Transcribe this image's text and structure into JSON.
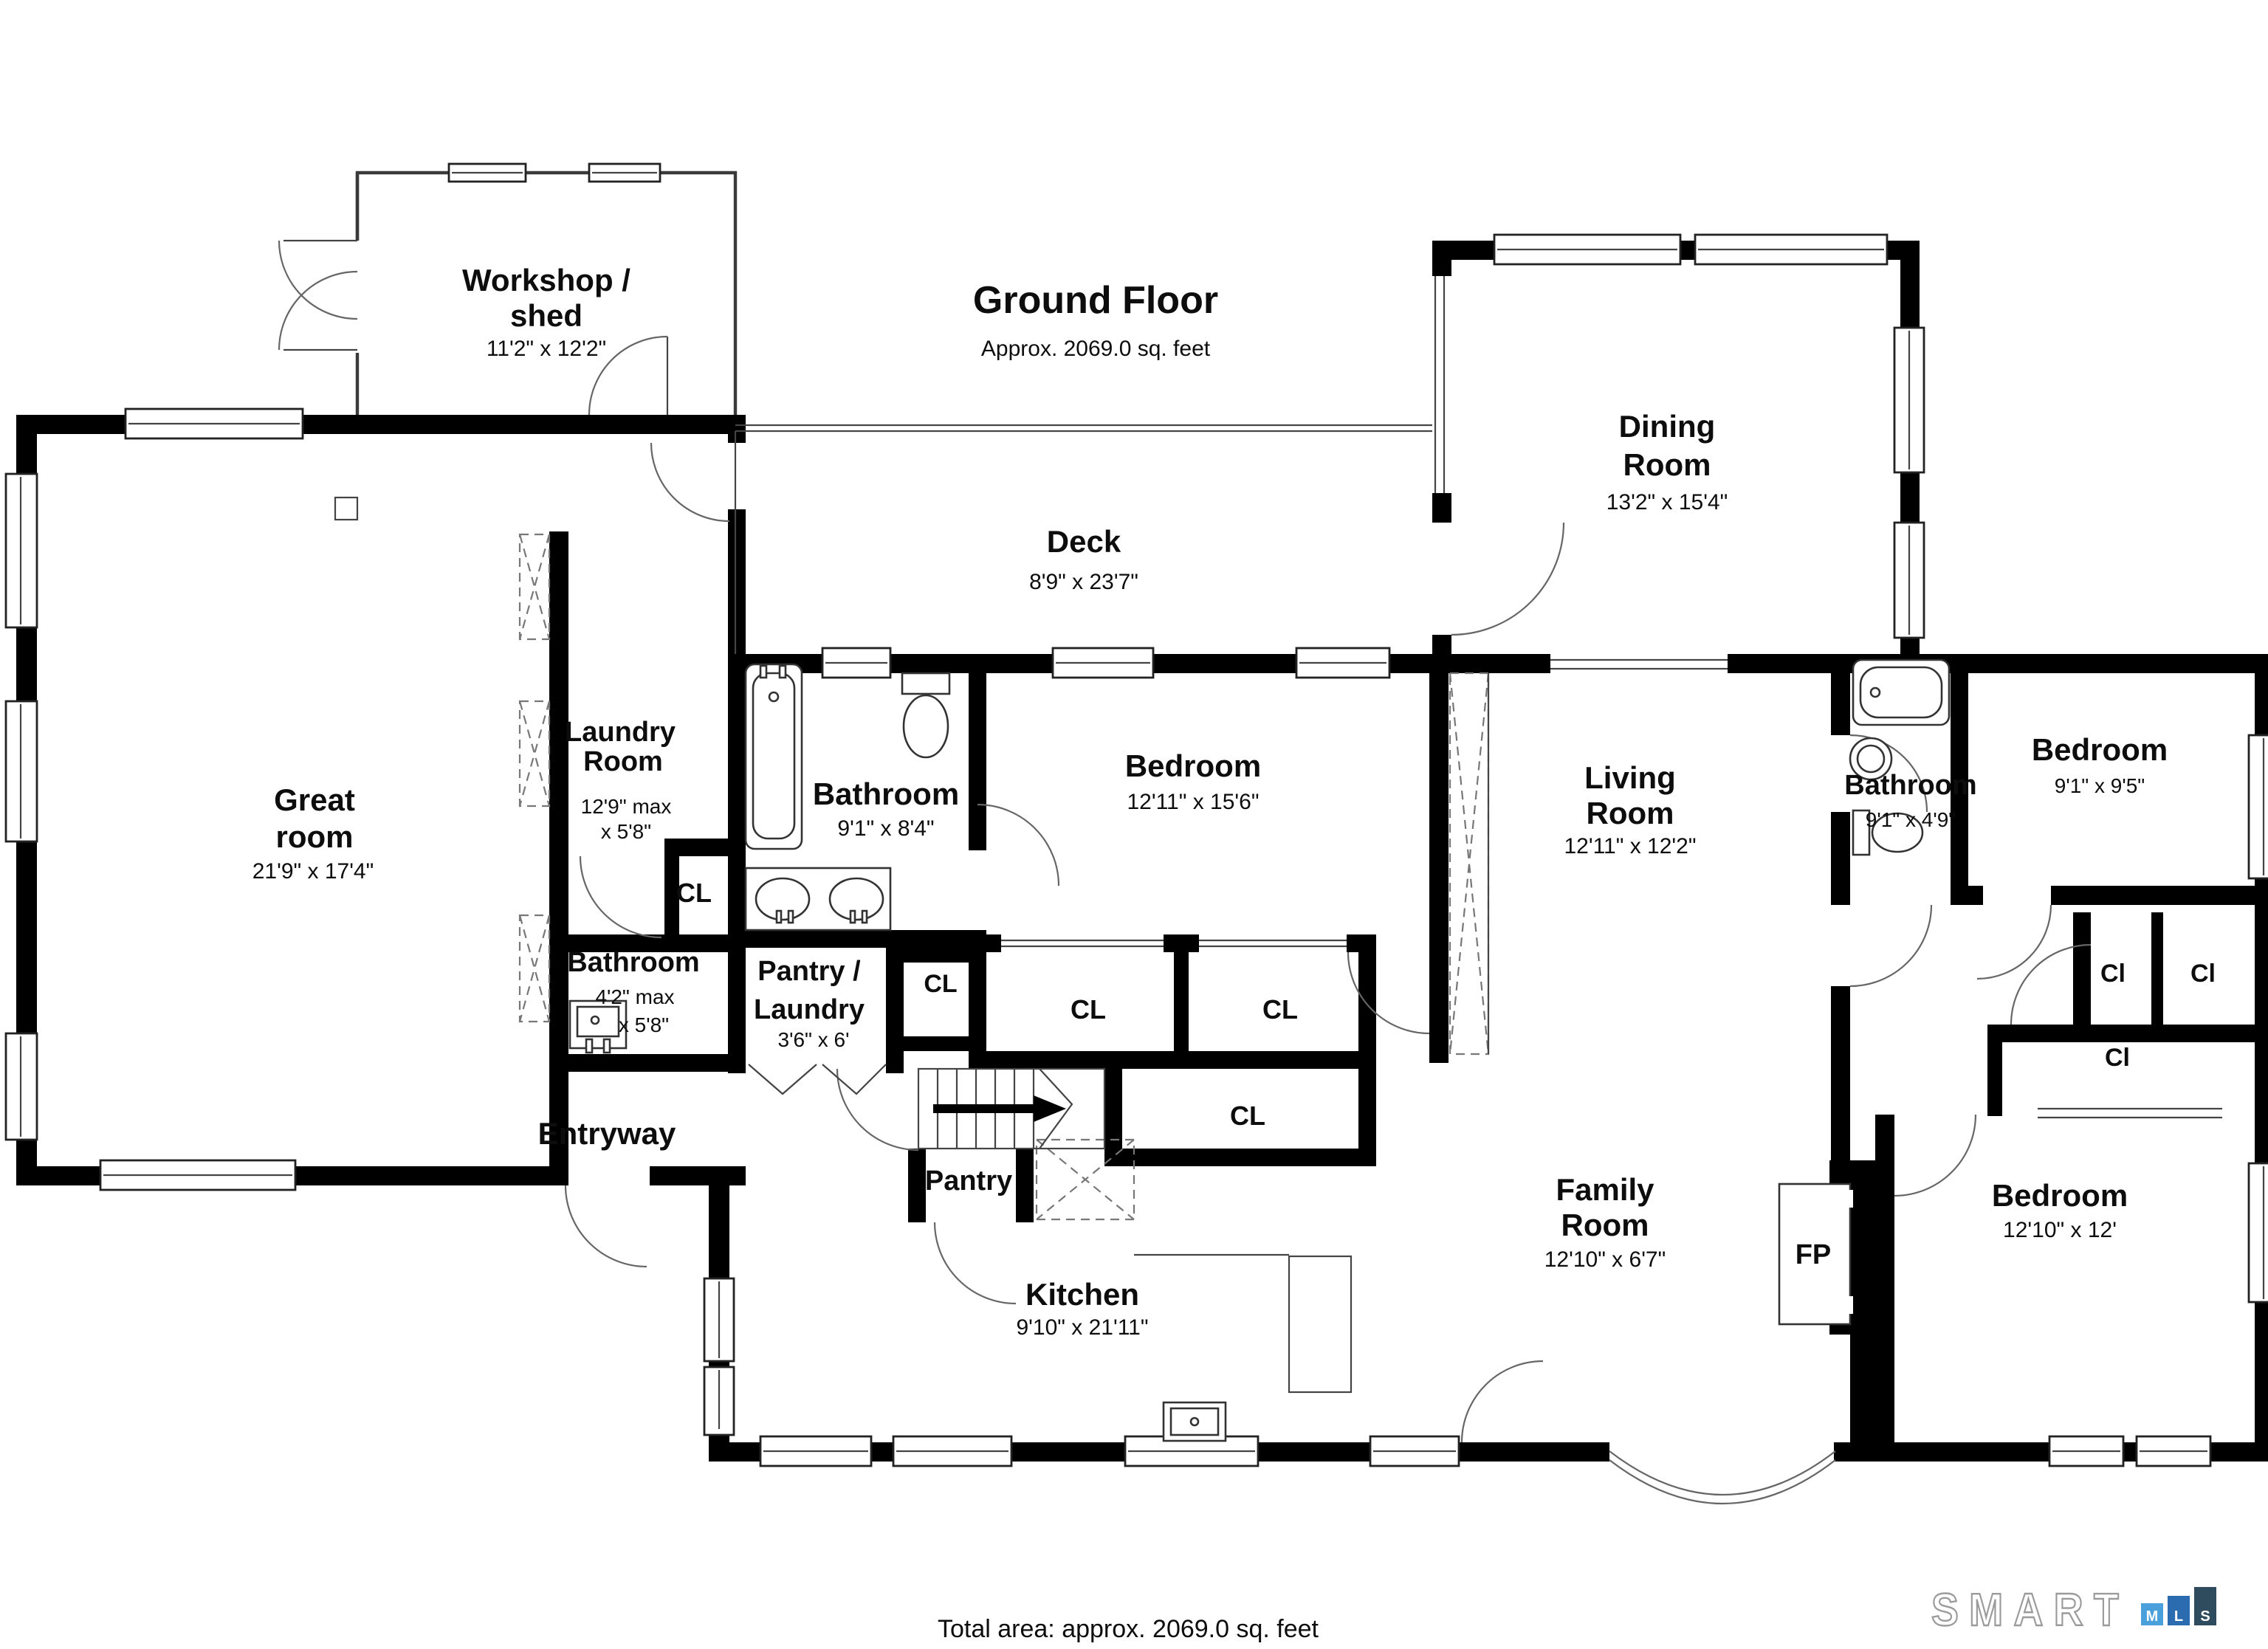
{
  "header": {
    "title": "Ground Floor",
    "subtitle": "Approx. 2069.0 sq. feet"
  },
  "footer": {
    "total_area": "Total area: approx. 2069.0 sq. feet"
  },
  "logo": {
    "word": "SMART",
    "tiles": [
      {
        "letter": "M",
        "color": "#4AA0DB"
      },
      {
        "letter": "L",
        "color": "#2B6CB0"
      },
      {
        "letter": "S",
        "color": "#2F4C5E"
      }
    ]
  },
  "rooms": {
    "workshop": {
      "name": "Workshop /",
      "name2": "shed",
      "dims": "11'2\" x 12'2\""
    },
    "deck": {
      "name": "Deck",
      "dims": "8'9\" x 23'7\""
    },
    "dining": {
      "name": "Dining",
      "name2": "Room",
      "dims": "13'2\" x 15'4\""
    },
    "great": {
      "name": "Great",
      "name2": "room",
      "dims": "21'9\" x 17'4\""
    },
    "laundry": {
      "name": "Laundry",
      "name2": "Room",
      "dims": "12'9\" max",
      "dims2": "x 5'8\""
    },
    "bathroom_main": {
      "name": "Bathroom",
      "dims": "9'1\" x 8'4\""
    },
    "bedroom_main": {
      "name": "Bedroom",
      "dims": "12'11\" x 15'6\""
    },
    "living": {
      "name": "Living",
      "name2": "Room",
      "dims": "12'11\" x 12'2\""
    },
    "bathroom_small": {
      "name": "Bathroom",
      "dims": "4'2\" max",
      "dims2": "x 5'8\""
    },
    "pantry_laundry": {
      "name": "Pantry /",
      "name2": "Laundry",
      "dims": "3'6\" x 6'"
    },
    "entryway": {
      "name": "Entryway"
    },
    "pantry": {
      "name": "Pantry"
    },
    "kitchen": {
      "name": "Kitchen",
      "dims": "9'10\" x 21'11\""
    },
    "family": {
      "name": "Family",
      "name2": "Room",
      "dims": "12'10\" x 6'7\""
    },
    "bathroom_hall": {
      "name": "Bathroom",
      "dims": "9'1\" x 4'9\""
    },
    "bedroom_ne": {
      "name": "Bedroom",
      "dims": "9'1\" x 9'5\""
    },
    "bedroom_se": {
      "name": "Bedroom",
      "dims": "12'10\" x 12'"
    },
    "fireplace": {
      "label": "FP"
    }
  },
  "closets": {
    "cl": "CL",
    "ci": "Cl"
  }
}
